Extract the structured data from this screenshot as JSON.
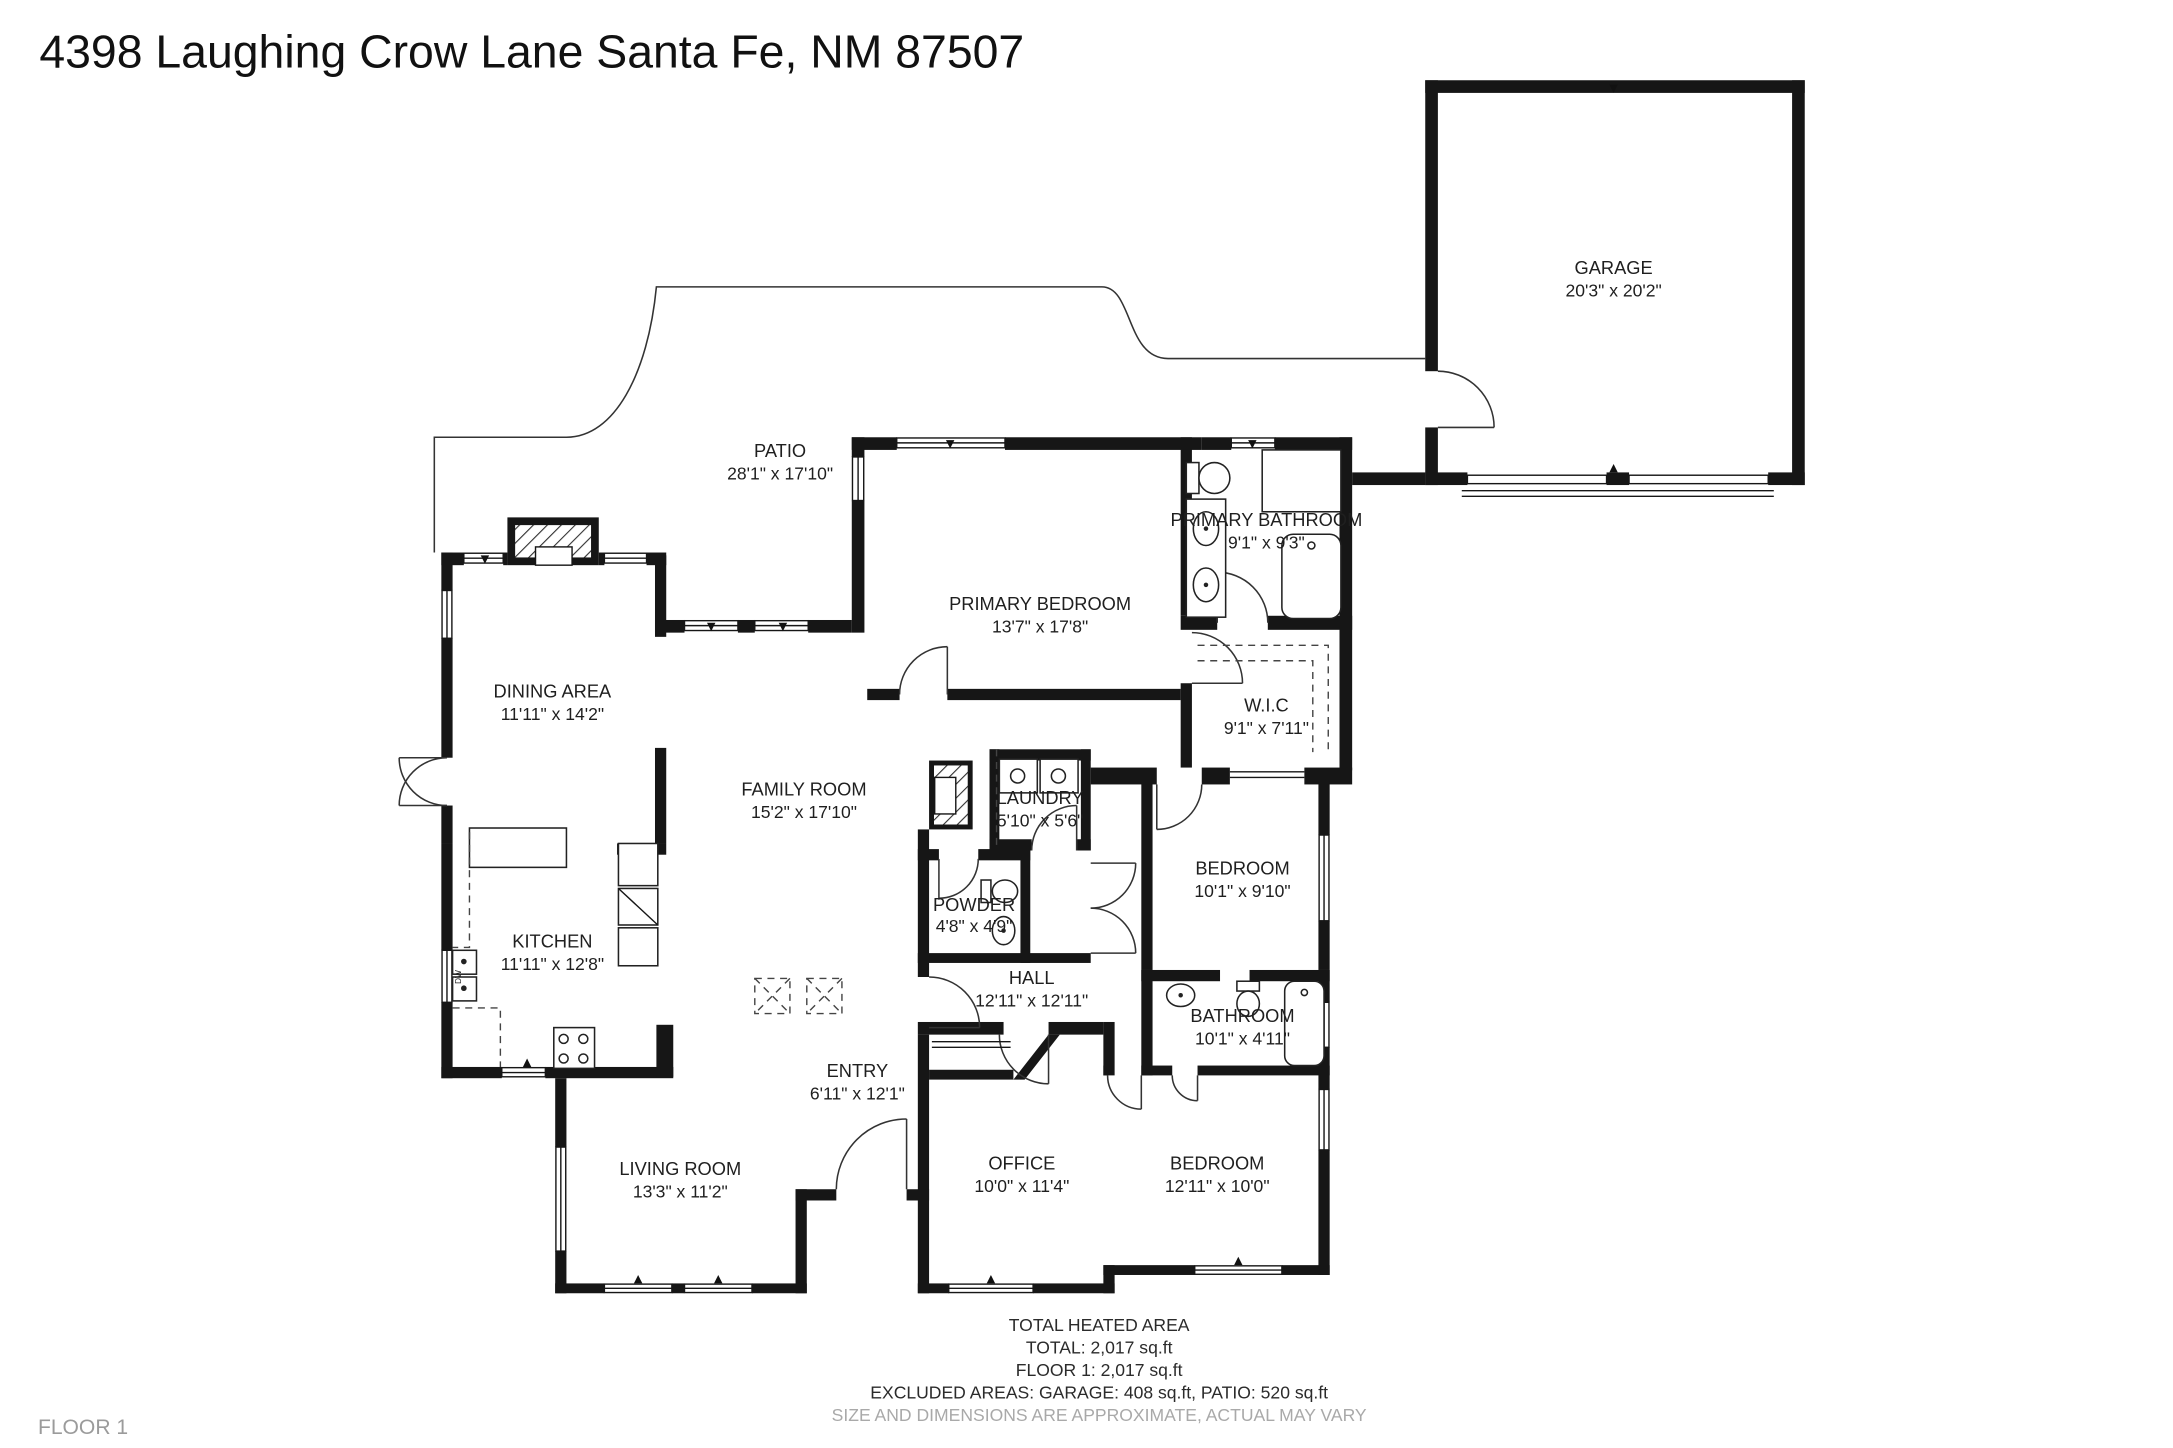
{
  "title": "4398 Laughing Crow Lane Santa Fe, NM 87507",
  "floor_label": "FLOOR 1",
  "kitchen_dw": "DW",
  "colors": {
    "wall": "#161616",
    "text": "#1f1f1f",
    "muted": "#9b9b9b",
    "background": "#ffffff"
  },
  "rooms": {
    "patio": {
      "name": "PATIO",
      "dims": "28'1\" x 17'10\""
    },
    "garage": {
      "name": "GARAGE",
      "dims": "20'3\" x 20'2\""
    },
    "primary_bedroom": {
      "name": "PRIMARY BEDROOM",
      "dims": "13'7\" x 17'8\""
    },
    "primary_bathroom": {
      "name": "PRIMARY BATHROOM",
      "dims": "9'1\" x 9'3\""
    },
    "wic": {
      "name": "W.I.C",
      "dims": "9'1\" x 7'11\""
    },
    "dining": {
      "name": "DINING AREA",
      "dims": "11'11\" x 14'2\""
    },
    "family": {
      "name": "FAMILY ROOM",
      "dims": "15'2\" x 17'10\""
    },
    "laundry": {
      "name": "LAUNDRY",
      "dims": "5'10\" x 5'6\""
    },
    "kitchen": {
      "name": "KITCHEN",
      "dims": "11'11\" x 12'8\""
    },
    "powder": {
      "name": "POWDER",
      "dims": "4'8\" x 4'9\""
    },
    "bedroom_ne": {
      "name": "BEDROOM",
      "dims": "10'1\" x 9'10\""
    },
    "hall": {
      "name": "HALL",
      "dims": "12'11\" x 12'11\""
    },
    "bathroom": {
      "name": "BATHROOM",
      "dims": "10'1\" x 4'11\""
    },
    "entry": {
      "name": "ENTRY",
      "dims": "6'11\" x 12'1\""
    },
    "living": {
      "name": "LIVING ROOM",
      "dims": "13'3\" x 11'2\""
    },
    "office": {
      "name": "OFFICE",
      "dims": "10'0\" x 11'4\""
    },
    "bedroom_se": {
      "name": "BEDROOM",
      "dims": "12'11\" x 10'0\""
    }
  },
  "summary": {
    "heading": "TOTAL HEATED AREA",
    "total": "TOTAL: 2,017 sq.ft",
    "floor1": "FLOOR 1: 2,017 sq.ft",
    "excluded": "EXCLUDED AREAS: GARAGE: 408 sq.ft, PATIO: 520 sq.ft",
    "disclaimer": "SIZE AND DIMENSIONS ARE APPROXIMATE, ACTUAL MAY VARY"
  }
}
